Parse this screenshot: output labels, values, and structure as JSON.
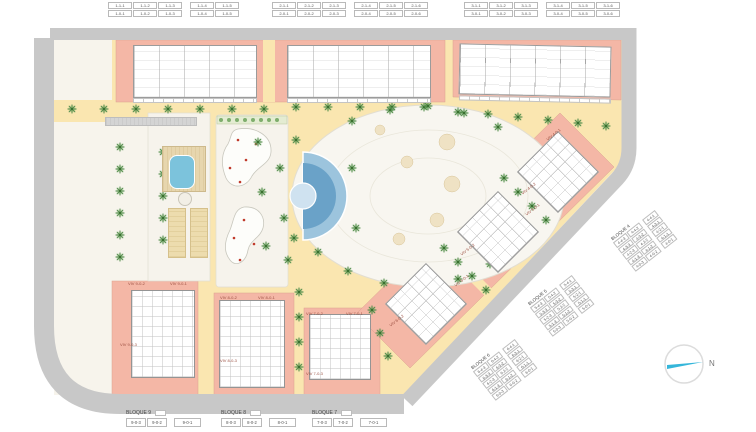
{
  "tables": {
    "top": [
      {
        "rows": [
          [
            "1-1-1",
            "1-1-2",
            "1-1-3",
            "1-1-4",
            "1-1-5"
          ],
          [
            "1-0-1",
            "1-0-2",
            "1-0-3",
            "1-0-4",
            "1-0-5"
          ]
        ]
      },
      {
        "rows": [
          [
            "2-1-1",
            "2-1-2",
            "2-1-3",
            "2-1-4",
            "2-1-5",
            "2-1-6"
          ],
          [
            "2-0-1",
            "2-0-2",
            "2-0-3",
            "2-0-4",
            "2-0-5",
            "2-0-6"
          ]
        ]
      },
      {
        "rows": [
          [
            "3-1-1",
            "3-1-2",
            "3-1-3",
            "3-1-4",
            "3-1-5",
            "3-1-6"
          ],
          [
            "3-0-1",
            "3-0-2",
            "3-0-3",
            "3-0-4",
            "3-0-5",
            "3-0-6"
          ]
        ]
      }
    ],
    "diagonal": [
      {
        "label": "BLOQUE 4",
        "rows": [
          [
            "4-4-3",
            "4-4-2",
            "4-4-1"
          ],
          [
            "4-3-3",
            "4-3-2",
            "4-3-1"
          ],
          [
            "4-2-3",
            "4-2-2",
            "4-2-1"
          ],
          [
            "4-1-3",
            "4-1-2",
            "4-1-1"
          ],
          [
            "4-0-3",
            "4-0-2",
            "4-0-1"
          ]
        ]
      },
      {
        "label": "BLOQUE 5",
        "rows": [
          [
            "5-4-3",
            "5-4-2",
            "5-4-1"
          ],
          [
            "5-3-3",
            "5-3-2",
            "5-3-1"
          ],
          [
            "5-2-3",
            "5-2-2",
            "5-2-1"
          ],
          [
            "5-1-3",
            "5-1-2",
            "5-1-1"
          ],
          [
            "5-0-3",
            "5-0-2",
            "5-0-1"
          ]
        ]
      },
      {
        "label": "BLOQUE 6",
        "rows": [
          [
            "6-4-3",
            "6-4-2",
            "6-4-1"
          ],
          [
            "6-3-3",
            "6-3-2",
            "6-3-1"
          ],
          [
            "6-2-3",
            "6-2-2",
            "6-2-1"
          ],
          [
            "6-1-3",
            "6-1-2",
            "6-1-1"
          ],
          [
            "6-0-3",
            "6-0-2",
            "6-0-1"
          ]
        ]
      }
    ],
    "bottom": [
      {
        "label": "BLOQUE 9",
        "rows": [
          [
            "9-0-3",
            "9-0-2",
            "9-0-1"
          ]
        ]
      },
      {
        "label": "BLOQUE 8",
        "rows": [
          [
            "8-0-3",
            "8-0-2",
            "8-0-1"
          ]
        ]
      },
      {
        "label": "BLOQUE 7",
        "rows": [
          [
            "7-0-3",
            "7-0-2",
            "7-0-1"
          ]
        ]
      }
    ]
  },
  "unit_labels": [
    "VIV 9-0-2",
    "VIV 9-0-1",
    "VIV 9-0-3",
    "VIV 8-0-2",
    "VIV 8-0-1",
    "VIV 8-0-3",
    "VIV 7-0-2",
    "VIV 7-0-1",
    "VIV 7-0-3",
    "VIV 4-0-1",
    "VIV 4-0-2",
    "VIV 5-0-1",
    "VIV 5-0-2",
    "VIV 6-0-1",
    "VIV 6-0-2"
  ],
  "compass": {
    "label": "N"
  },
  "colors": {
    "plot_salmon": "#f4b7a6",
    "path_yellow": "#fae6b0",
    "road_gray": "#c8c8c8",
    "pool_blue": "#6aa2c8",
    "tree_green": "#4f8c4a",
    "flower_red": "#c03a2b",
    "deck_tan": "#e7d6ae",
    "compass_cyan": "#35b6da"
  }
}
